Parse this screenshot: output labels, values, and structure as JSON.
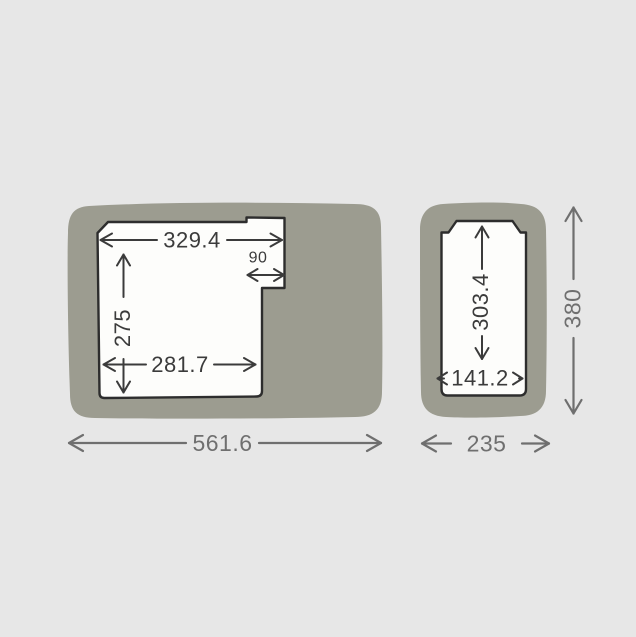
{
  "measurements": {
    "left_compartment": {
      "top_width": "329.4",
      "step_width": "90",
      "inner_height": "275",
      "bottom_width": "281.7",
      "overall_width": "561.6"
    },
    "right_compartment": {
      "inner_height": "303.4",
      "inner_width": "141.2",
      "overall_height": "380",
      "overall_width": "235"
    }
  },
  "colors": {
    "background": "#e7e7e7",
    "body_fill": "#9c9c90",
    "liner_fill": "#fdfdfb",
    "liner_outline": "#2d2d2d",
    "inner_dimension_color": "#3b3b3b",
    "outer_dimension_color": "#6f6f6f"
  }
}
